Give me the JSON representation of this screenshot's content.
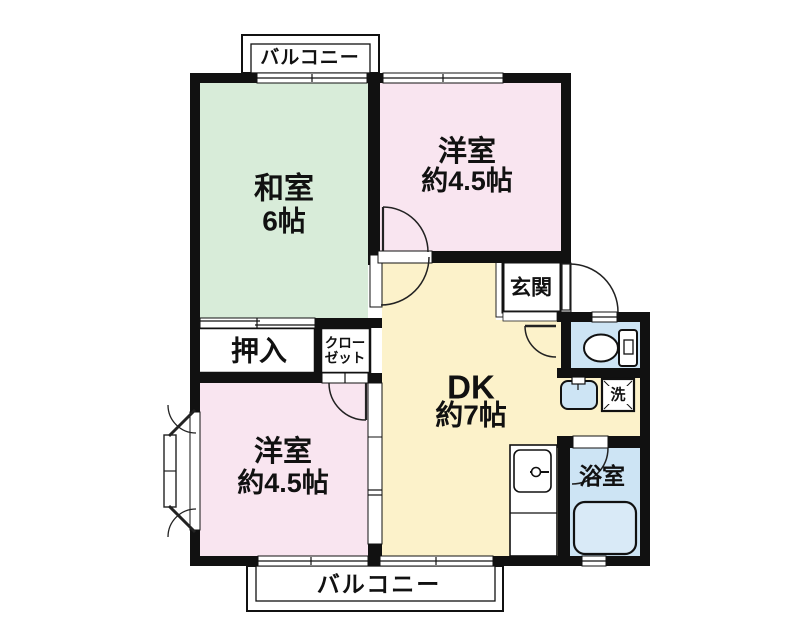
{
  "plan": {
    "type": "floorplan",
    "rooms": {
      "washitsu": {
        "name": "和室",
        "size": "6帖"
      },
      "yoshitsu_upper": {
        "name": "洋室",
        "size": "約4.5帖"
      },
      "yoshitsu_lower": {
        "name": "洋室",
        "size": "約4.5帖"
      },
      "dk": {
        "name": "DK",
        "size": "約7帖"
      },
      "genkan": {
        "label": "玄関"
      },
      "oshiire": {
        "label": "押入"
      },
      "closet": {
        "line1": "クロー",
        "line2": "ゼット"
      },
      "bathroom": {
        "label": "浴室"
      },
      "laundry": {
        "label": "洗"
      },
      "balcony_top": {
        "label": "バルコニー"
      },
      "balcony_bottom": {
        "label": "バルコニー"
      }
    },
    "colors": {
      "tatami_green": "#d8ecd9",
      "western_pink": "#f9e5f0",
      "dk_yellow": "#fcf2ca",
      "wet_blue": "#cde4f4",
      "wall_black": "#111111",
      "line": "#222222",
      "bg": "#ffffff"
    }
  }
}
